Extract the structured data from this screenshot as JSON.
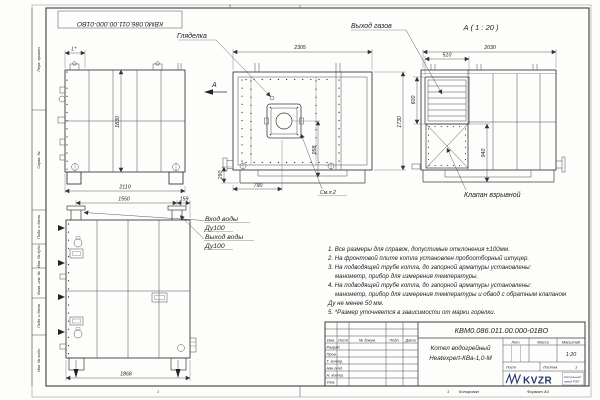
{
  "frame": {
    "stamp_number": "КВМ0.086.011.00.000-01ВО",
    "zone_top": "1",
    "zone_bottom_left": "1",
    "strips": [
      "Перв. примен.",
      "Справ. №",
      "Подп. и дата",
      "Инв. № дубл.",
      "Взам. инв. №",
      "Подп. и дата",
      "Инв. № подл."
    ],
    "footer": {
      "num": "1",
      "copied": "Копировал",
      "format": "Формат А3"
    }
  },
  "views": {
    "side": {
      "dims": {
        "offset": "L*",
        "height": "1830",
        "width": "2110"
      }
    },
    "front": {
      "labels": {
        "sight": "Гляделка",
        "arrow": "А",
        "see": "См.п.2"
      },
      "dims": {
        "width": "2305",
        "height": "1730",
        "burner": "958",
        "base": "290",
        "burner_x": "790"
      }
    },
    "a": {
      "title": "А ( 1 : 20 )",
      "labels": {
        "gas": "Выход газов",
        "valve": "Клапан взрывной"
      },
      "dims": {
        "width": "2030",
        "grille_w": "510",
        "grille_h": "600",
        "valve_h": "940"
      }
    },
    "rear": {
      "labels": {
        "inlet": "Вход воды",
        "inlet_dn": "Ду100",
        "outlet": "Выход воды",
        "outlet_dn": "Ду100"
      },
      "dims": {
        "span": "1550",
        "offset": "159",
        "width": "1868"
      }
    }
  },
  "notes": [
    "1. Все размеры для справок, допустимые отклонения ±100мм.",
    "2. На фронтовой плите котла установлен пробоотборный штуцер.",
    "3. На подводящей трубе котла, до запорной арматуры установлены:",
    "манометр, прибор для измерения температуры.",
    "4. На подводящей трубе котла, до запорной арматуры установлены:",
    "манометр, прибор для измерения температуры и обвод с обратным клапаном",
    "Ду не менее 50 мм.",
    "5. *Размер уточняется в зависимости от марки горелки."
  ],
  "title_block": {
    "doc_number": "КВМ0.086.011.00.000-01ВО",
    "name_line1": "Котел водогрейный",
    "name_line2": "Heatexpert-КВа-1,0-М",
    "header_cols": [
      "Изм.",
      "Лист",
      "№ докум.",
      "Подп.",
      "Дата"
    ],
    "rows": [
      "Разраб.",
      "Пров.",
      "Т. контр.",
      "Нач.отд.",
      "Н. контр.",
      "Утв."
    ],
    "lit_label": "Лит.",
    "mass_label": "Масса",
    "scale_label": "Масштаб",
    "scale_value": "1:20",
    "sheet_label": "Лист",
    "sheets_label": "Листов",
    "sheets_value": "1",
    "logo_text": "KVZR",
    "logo_caption_line1": "Котельный",
    "logo_caption_line2": "завод РЭП"
  }
}
